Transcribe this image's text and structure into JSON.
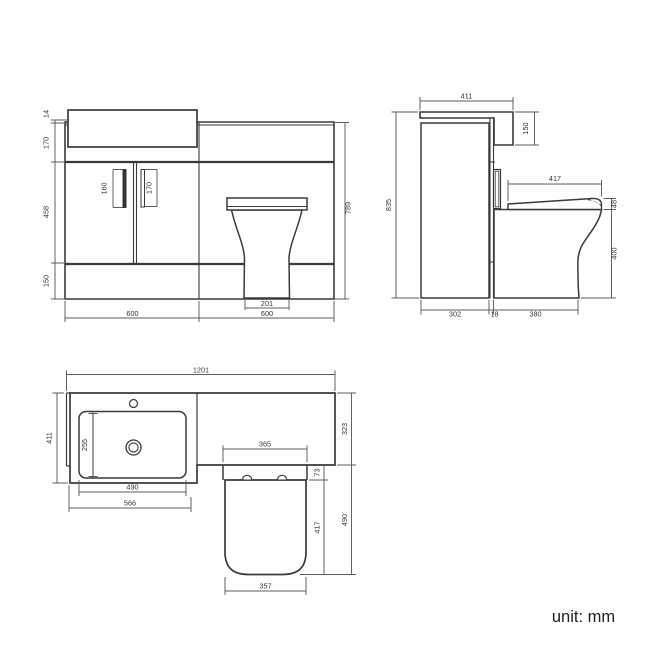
{
  "footer": {
    "unit_label": "unit: mm"
  },
  "views": {
    "front": {
      "dims": {
        "countertop_thickness": "14",
        "upper_section_height": "170",
        "door_height": "458",
        "plinth_height": "150",
        "overall_height": "789",
        "left_handle_length": "160",
        "right_handle_length": "170",
        "toilet_base_width": "201",
        "vanity_width": "600",
        "wc_unit_width": "600"
      }
    },
    "side": {
      "dims": {
        "countertop_depth": "411",
        "basin_drop": "150",
        "overall_height": "835",
        "seat_depth": "417",
        "seat_thickness": "48",
        "pan_height": "400",
        "cabinet_depth": "302",
        "gap_width": "18",
        "pan_projection": "380"
      }
    },
    "plan": {
      "dims": {
        "overall_width": "1201",
        "left_depth": "411",
        "basin_inner_depth": "255",
        "basin_width": "490",
        "vanity_unit_width": "566",
        "wc_width": "365",
        "seat_setback": "73",
        "seat_depth": "417",
        "wc_overall_depth": "490",
        "right_depth": "323",
        "seat_width": "357"
      }
    }
  }
}
